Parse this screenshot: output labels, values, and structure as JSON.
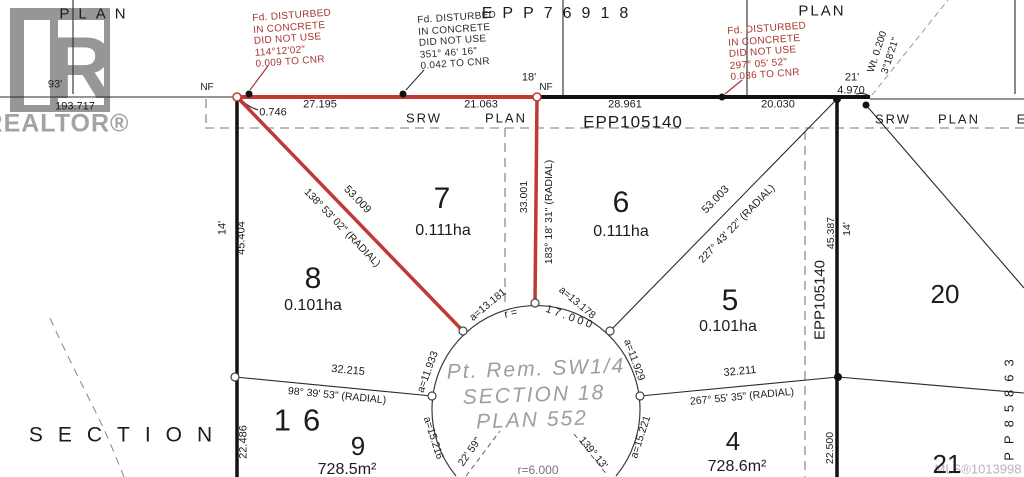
{
  "branding": {
    "logo_letter": "R",
    "realtor": "REALTOR®",
    "mls": "MLS®1013998"
  },
  "titles": {
    "plan_top_left": "PLAN",
    "epp_top": "EPP76918",
    "plan_top_right": "PLAN",
    "srw_left": "SRW",
    "srw_left_plan": "PLAN",
    "epp105140_horizontal": "EPP105140",
    "srw_right": "SRW",
    "srw_right_plan": "PLAN",
    "srw_right_e": "E",
    "section_word": "SECTION"
  },
  "notes": {
    "note1": "Fd. DISTURBED\nIN CONCRETE\nDID NOT USE\n114°12'02\"\n0.009 TO CNR",
    "note2": "Fd. DISTURBED\nIN CONCRETE\nDID NOT USE\n351° 46' 16\"\n0.042 TO CNR",
    "note3": "Fd. DISTURBED\nIN CONCRETE\nDID NOT USE\n297° 05' 52\"\n0.036 TO CNR"
  },
  "top_line": {
    "ft93": "93'",
    "d193717": "193.717",
    "nf_left": "NF",
    "d0746": "0.746",
    "d27195": "27.195",
    "d21063": "21.063",
    "ft18": "18'",
    "nf_mid": "NF",
    "d28961": "28.961",
    "d20030": "20.030",
    "ft21": "21'",
    "d4970": "4.970",
    "wt": "Wt. 0.200",
    "wt_bearing": "3°18'21\""
  },
  "left_edge": {
    "ft14": "14'",
    "d45404": "45.404",
    "d22486": "22.486"
  },
  "right_edge": {
    "epp105140_vertical": "EPP105140",
    "d45387": "45.387",
    "ft14": "14'",
    "d22500": "22.500",
    "pp85863": "PP85863"
  },
  "lots": {
    "lot7": {
      "number": "7",
      "area": "0.111ha"
    },
    "lot8": {
      "number": "8",
      "area": "0.101ha"
    },
    "lot6": {
      "number": "6",
      "area": "0.111ha"
    },
    "lot5": {
      "number": "5",
      "area": "0.101ha"
    },
    "lot20": {
      "number": "20"
    },
    "lot16": {
      "number": "16"
    },
    "lot9": {
      "number": "9",
      "area": "728.5m²"
    },
    "lot4": {
      "number": "4",
      "area": "728.6m²"
    },
    "lot21": {
      "number": "21"
    }
  },
  "edges": {
    "d53009": "53.009",
    "b138": "138° 53' 02\" (RADIAL)",
    "d33001": "33.001",
    "b183": "183° 18' 31\" (RADIAL)",
    "d53003": "53.003",
    "b227": "227° 43' 22\" (RADIAL)",
    "d32215": "32.215",
    "b98": "98° 39' 53\" (RADIAL)",
    "d32211": "32.211",
    "b267": "267° 55' 35\" (RADIAL)",
    "b2259": "22' 59\"",
    "b13913": "139° 13'"
  },
  "culdesac": {
    "a11933": "a=11.933",
    "a13181": "a=13.181",
    "a13178": "a=13.178",
    "a11929": "a=11.929",
    "a15216": "a=15.216",
    "a15221": "a=15.221",
    "r17_prefix": "r =",
    "r17": "17.000",
    "r6": "r=6.000",
    "remainder_line1": "Pt. Rem. SW1/4",
    "remainder_line2": "SECTION 18",
    "remainder_line3": "PLAN 552"
  },
  "colors": {
    "highlight_red": "#bf3a32",
    "line_black": "#1c1c1c",
    "logo_gray": "#969696"
  }
}
